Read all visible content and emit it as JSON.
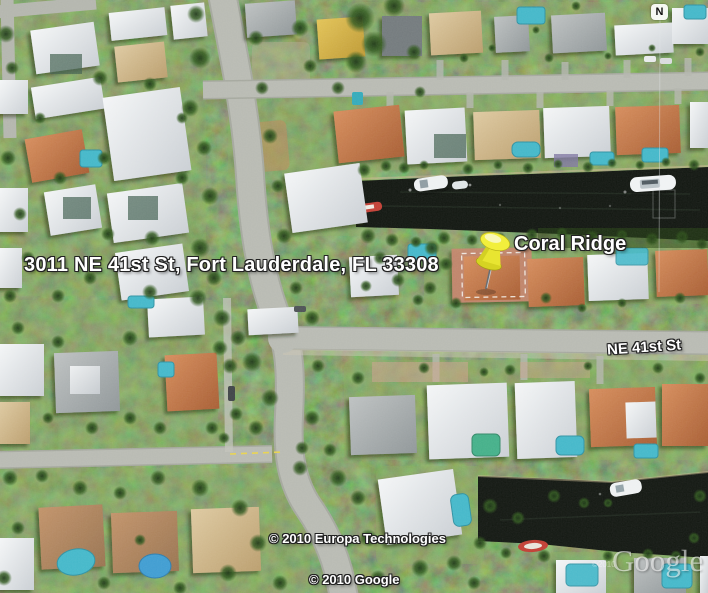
{
  "map_overlay": {
    "address_label": "3011 NE 41st St, Fort Lauderdale, FL 33308",
    "place_label": "Coral Ridge",
    "street_label": "NE 41st St",
    "copyright_imagery": "© 2010 Europa Technologies",
    "copyright_google": "© 2010 Google",
    "watermark_small": "©2010",
    "watermark_logo": "Google",
    "north_indicator": "N"
  },
  "placemark": {
    "icon": "yellow-pushpin",
    "head_color": "#f2ef3c",
    "selection_style": "dashed-white-parcel-outline"
  },
  "palette": {
    "water": "#0b100a",
    "road": "#b7b9b1",
    "vegetation": "#3f6527",
    "roof_white": "#e9ecee",
    "roof_tile": "#c4754a",
    "pool": "#3fb6c8",
    "label_text": "#ffffff",
    "label_outline": "#222222"
  }
}
